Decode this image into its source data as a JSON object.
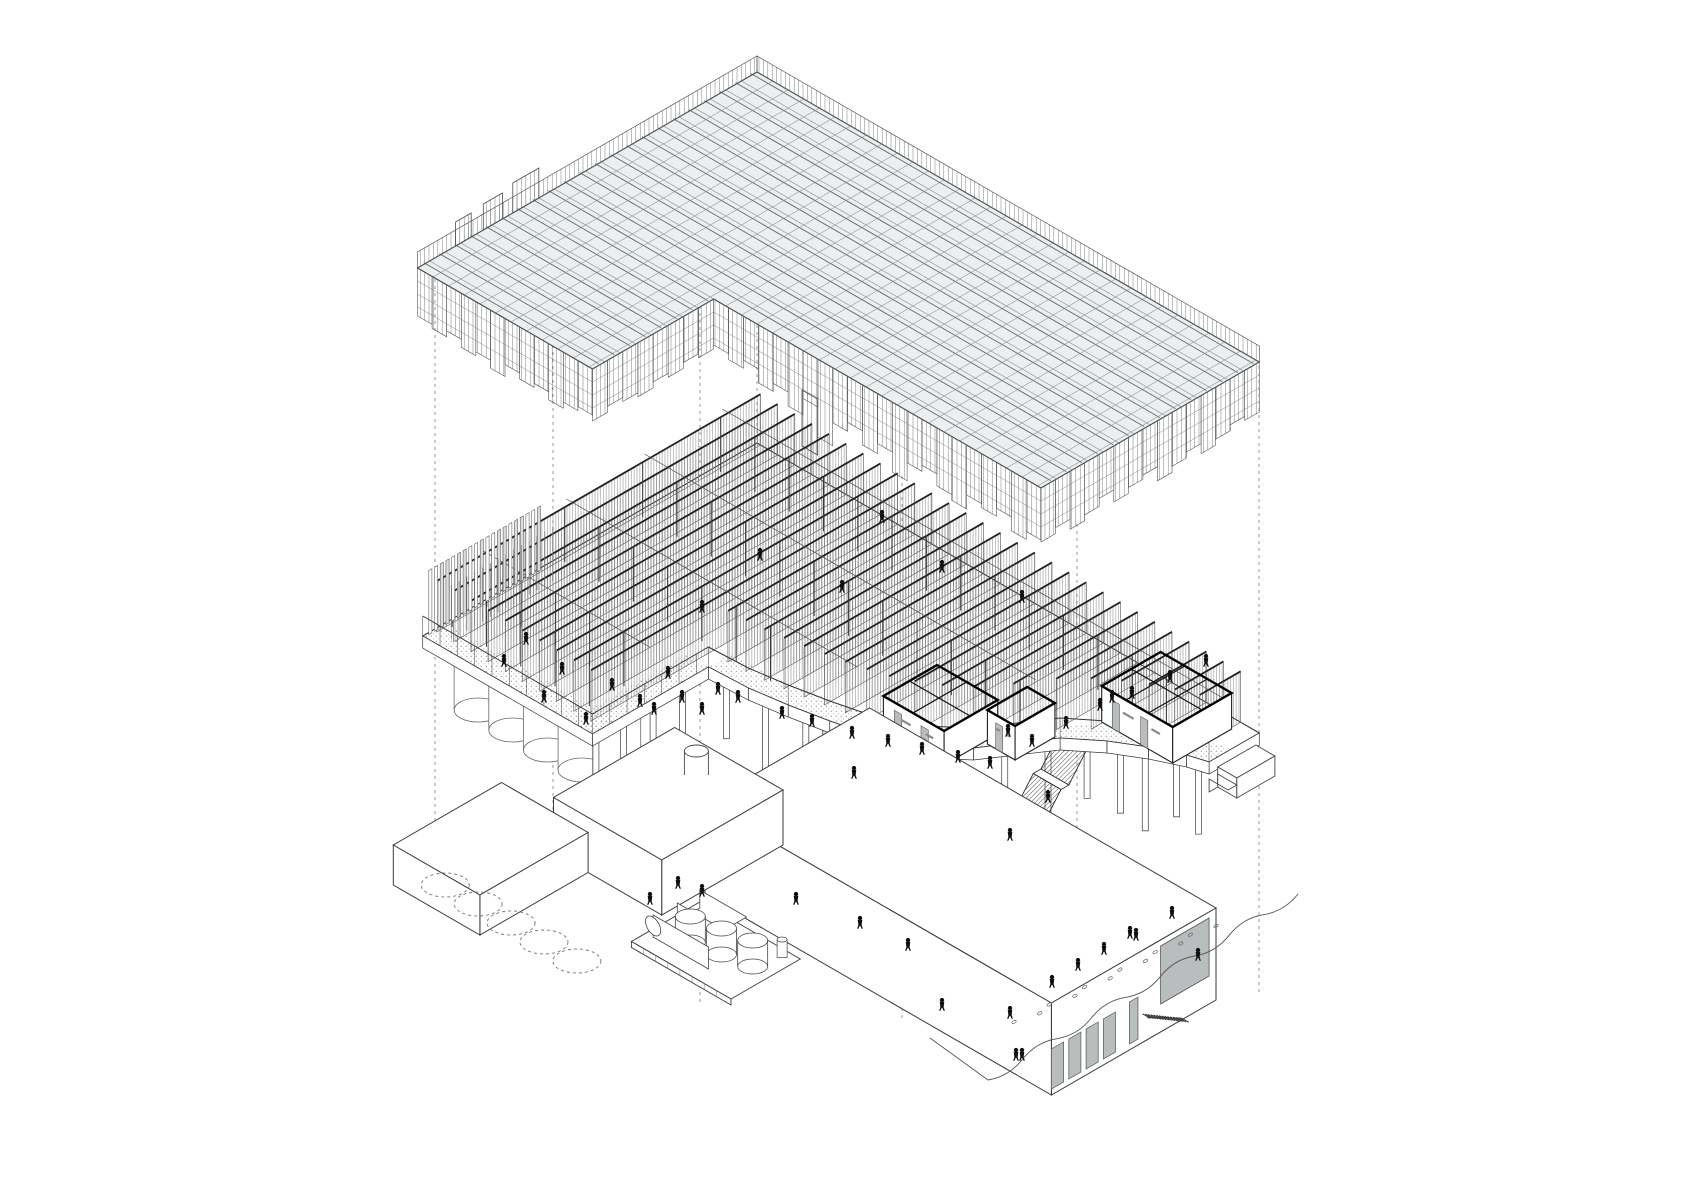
{
  "drawing": {
    "type": "exploded-axonometric-building-drawing",
    "background": "#ffffff",
    "palette": {
      "ink": "#3a3a3a",
      "ink_strong": "#141414",
      "roof_fill": "#eceff0",
      "roof_line": "#8a9296",
      "roof_ridge": "#5f686b",
      "grey_panel": "#b9bdbd",
      "guide": "#9a9a9a",
      "figure": "#101010",
      "stipple": "#8f8f8f",
      "hatch": "#6f6f6f"
    },
    "iso": {
      "cos": 0.866,
      "sin": 0.5
    },
    "guides": [
      {
        "x": 435,
        "y1": 272,
        "y2": 846
      },
      {
        "x": 553,
        "y1": 338,
        "y2": 884
      },
      {
        "x": 700,
        "y1": 306,
        "y2": 1006
      },
      {
        "x": 757,
        "y1": 80,
        "y2": 448
      },
      {
        "x": 902,
        "y1": 476,
        "y2": 1018
      },
      {
        "x": 1077,
        "y1": 524,
        "y2": 1008
      },
      {
        "x": 1259,
        "y1": 366,
        "y2": 996
      }
    ],
    "roof": {
      "origin": [
        757,
        72
      ],
      "main": {
        "u0": 0,
        "u1": 580,
        "v0": 0,
        "v1": 252
      },
      "wing": {
        "u0": 0,
        "u1": 202,
        "v0": 252,
        "v1": 392
      },
      "cell_u": 18,
      "cell_v": 18,
      "parapet_h": 16,
      "teeth": [
        [
          252,
          282,
          30
        ],
        [
          294,
          316,
          26
        ],
        [
          330,
          348,
          24
        ]
      ],
      "hem_front": [
        46,
        52,
        44,
        58,
        50,
        64,
        48,
        78,
        55,
        46,
        60,
        50,
        70,
        52,
        46,
        58,
        64,
        50,
        54,
        46,
        60,
        52
      ],
      "hem_right": [
        50,
        46,
        52,
        58,
        48,
        54,
        60,
        46,
        50,
        56,
        44,
        52,
        58,
        48,
        54
      ],
      "hem_wing": [
        48,
        52,
        46,
        54,
        50,
        58,
        46,
        52,
        48,
        56,
        50,
        46
      ],
      "hem_wing_side": [
        50,
        46,
        52,
        48,
        54,
        50,
        46,
        52
      ],
      "tab": {
        "u0": 304,
        "u1": 322,
        "depth": 96
      }
    },
    "floor": {
      "origin": [
        757,
        455
      ],
      "slab_z_top": 12,
      "back_u1": 580,
      "wing": {
        "u1": 196,
        "v1": 386
      },
      "torn_edge": [
        [
          196,
          252
        ],
        [
          240,
          250
        ],
        [
          280,
          244
        ],
        [
          320,
          236
        ],
        [
          360,
          226
        ],
        [
          400,
          206
        ],
        [
          430,
          180
        ],
        [
          450,
          150
        ],
        [
          470,
          120
        ],
        [
          500,
          96
        ],
        [
          530,
          78
        ],
        [
          560,
          64
        ],
        [
          580,
          58
        ]
      ],
      "beams": {
        "count": 29,
        "u_start": 8,
        "u_step": 19.8,
        "z_top": 66,
        "z_bottom": 16,
        "v_start": 4,
        "v_max_main": 246,
        "v_max_wing": 378
      },
      "purlins": [
        40,
        130,
        220,
        320
      ],
      "columns_v": [
        50,
        140,
        230,
        320,
        360
      ],
      "fence": {
        "u": 2,
        "v0": 252,
        "v1": 384,
        "step": 6.6,
        "height": 64,
        "second_row_u": 20
      },
      "walkway_width": 26,
      "rooms": [
        {
          "u0": 360,
          "u1": 430,
          "v0": 152,
          "v1": 214,
          "h": 34,
          "partitions_u": [
            394
          ],
          "partitions_v": [
            184
          ],
          "doors": [
            [
              0.18,
              0.3
            ],
            [
              0.62,
              0.74
            ]
          ]
        },
        {
          "u0": 434,
          "u1": 466,
          "v0": 122,
          "v1": 168,
          "h": 34,
          "partitions_u": [],
          "partitions_v": [],
          "doors": [
            [
              0.3,
              0.55
            ]
          ]
        },
        {
          "u0": 478,
          "u1": 560,
          "v0": 12,
          "v1": 80,
          "h": 36,
          "partitions_u": [
            506,
            532
          ],
          "partitions_v": [
            46
          ],
          "doors": [
            [
              0.15,
              0.25
            ],
            [
              0.55,
              0.65
            ]
          ]
        }
      ],
      "stair_tower": {
        "u": 330,
        "v": 236,
        "w": 18,
        "z_top": 12,
        "z_bottom": -112
      },
      "escalator": {
        "u": 470,
        "w": 16,
        "v_start": 96,
        "flights": 4,
        "flight_dv": 30,
        "landing_dv": 9,
        "flight_dz": 36
      },
      "edge_piles": {
        "us": [
          210,
          252,
          292,
          374,
          414,
          442,
          462,
          484,
          506,
          524,
          548,
          566
        ],
        "lens": [
          56,
          72,
          48,
          66,
          80,
          58,
          70,
          50,
          62,
          76,
          56,
          68
        ]
      },
      "notch_piles": {
        "u": 186,
        "vs": [
          272,
          306,
          340,
          372
        ],
        "len": 52
      },
      "silos": {
        "count": 5,
        "u0": 16,
        "du": 40,
        "v": 338,
        "r": 24,
        "len": 78
      },
      "truck": {
        "u0": 536,
        "u1": 558,
        "v0": -40,
        "v1": 4,
        "z0": -62,
        "h": 20,
        "cab_v1": 14,
        "cab_h": 13
      }
    },
    "podium": {
      "origin": [
        757,
        735
      ],
      "box_main": {
        "u0": 130,
        "u1": 530,
        "v0": 0,
        "v1": 190,
        "h": 92
      },
      "garage_door": {
        "v0": 8,
        "v1": 64,
        "z0": 28,
        "z1": 86
      },
      "narrow_door": {
        "v0": 90,
        "v1": 100,
        "z0": 6,
        "z1": 48
      },
      "doors": {
        "v_list": [
          116,
          136,
          156,
          176
        ],
        "w": 14,
        "z0": 6,
        "z1": 46
      },
      "comb_stair": {
        "v0": 40,
        "v1": 88,
        "treads": 15
      },
      "box_mid": {
        "u0": 0,
        "u1": 125,
        "v0": 95,
        "v1": 235,
        "h": 55
      },
      "chimney": {
        "u": 60,
        "v": 130,
        "r": 12,
        "h": 24
      },
      "box_left": {
        "u0": -60,
        "u1": 40,
        "v0": 235,
        "v1": 360,
        "h": 40
      },
      "plinth": {
        "u0": 140,
        "u1": 255,
        "v0": 205,
        "v1": 285,
        "h": 6
      },
      "round_tanks": [
        [
          235,
          240
        ],
        [
          205,
          246
        ],
        [
          175,
          252
        ]
      ],
      "tank_r": 15,
      "tank_h": 26,
      "horiz_tank": {
        "u0": 148,
        "u1": 212,
        "v": 268,
        "r": 11
      },
      "tank_box": {
        "u0": 146,
        "u1": 200,
        "v0": 212,
        "v1": 238,
        "h": 18
      },
      "pipe": {
        "u": 243,
        "v": 214,
        "r": 5,
        "h": 18
      },
      "dashed_circles": {
        "count": 5,
        "u0": -30,
        "du": 38,
        "v": 330,
        "rx": 24,
        "ry": 12
      },
      "ground_line": {
        "p0": [
          930,
          1038
        ],
        "p1": [
          988,
          1080
        ],
        "p2": [
          1298,
          894
        ],
        "waves": 9,
        "amp": 7
      },
      "footprints": {
        "from": [
          1018,
          1022
        ],
        "to": [
          1212,
          926
        ],
        "count": 12
      }
    },
    "figures": {
      "floor": [
        [
          612,
          690
        ],
        [
          640,
          706
        ],
        [
          654,
          714
        ],
        [
          668,
          678
        ],
        [
          682,
          702
        ],
        [
          702,
          714
        ],
        [
          718,
          694
        ],
        [
          738,
          702
        ],
        [
          586,
          724
        ],
        [
          562,
          674
        ],
        [
          544,
          702
        ],
        [
          526,
          644
        ],
        [
          504,
          666
        ],
        [
          760,
          560
        ],
        [
          842,
          592
        ],
        [
          942,
          572
        ],
        [
          1022,
          602
        ],
        [
          882,
          522
        ],
        [
          702,
          612
        ],
        [
          782,
          718
        ],
        [
          812,
          726
        ],
        [
          852,
          738
        ],
        [
          888,
          746
        ],
        [
          922,
          754
        ],
        [
          958,
          762
        ],
        [
          990,
          768
        ],
        [
          1032,
          746
        ],
        [
          1066,
          728
        ],
        [
          1100,
          710
        ],
        [
          1132,
          698
        ],
        [
          1170,
          682
        ],
        [
          1206,
          666
        ],
        [
          1010,
          840
        ],
        [
          1048,
          802
        ],
        [
          854,
          778
        ],
        [
          1008,
          736
        ],
        [
          1112,
          702
        ]
      ],
      "ground": [
        [
          678,
          888
        ],
        [
          702,
          896
        ],
        [
          796,
          904
        ],
        [
          860,
          928
        ],
        [
          908,
          950
        ],
        [
          942,
          1010
        ],
        [
          1010,
          1018
        ],
        [
          1016,
          1060
        ],
        [
          1022,
          1060
        ],
        [
          1052,
          987
        ],
        [
          1078,
          970
        ],
        [
          1104,
          954
        ],
        [
          1130,
          938
        ],
        [
          1136,
          940
        ],
        [
          1172,
          918
        ],
        [
          1198,
          960
        ],
        [
          650,
          904
        ]
      ]
    }
  }
}
